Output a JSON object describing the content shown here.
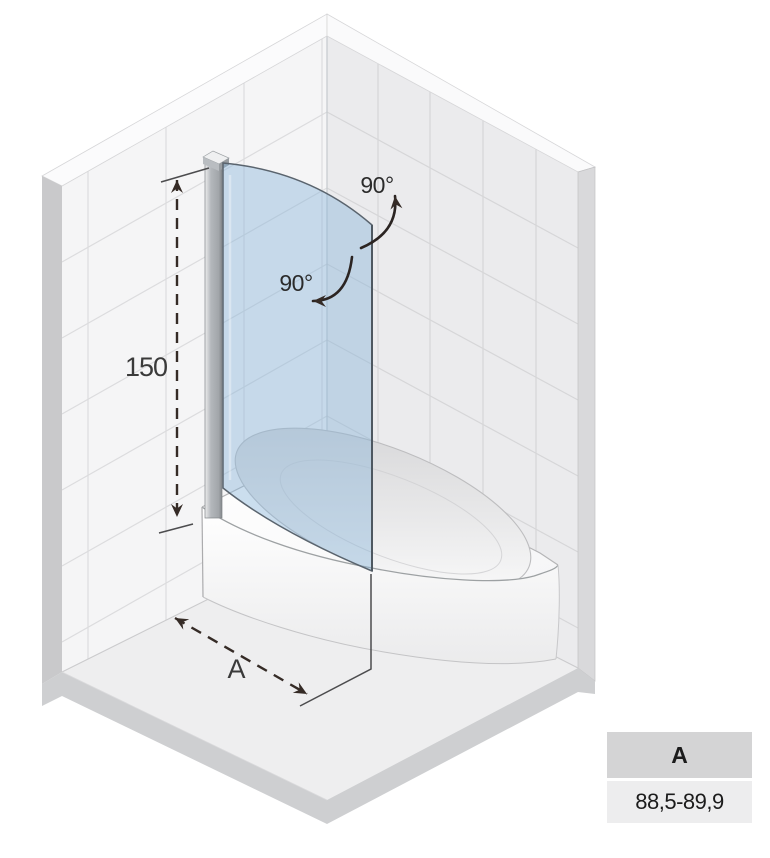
{
  "diagram": {
    "height_dimension": "150",
    "width_dimension_label": "A",
    "swing_angle_top": "90°",
    "swing_angle_bottom": "90°",
    "colors": {
      "glass": "#86b2d9",
      "glass_edge": "#55616b",
      "left_wall": "#f5f5f6",
      "right_wall": "#ebebed",
      "floor": "#eeeeef",
      "floor_side": "#cecfd1",
      "dimension_ink": "#352b26",
      "profile_metal": "#b3b7bb"
    }
  },
  "spec_table": {
    "header": "A",
    "value": "88,5-89,9",
    "header_bg": "#d4d4d5",
    "value_bg": "#ededee"
  }
}
